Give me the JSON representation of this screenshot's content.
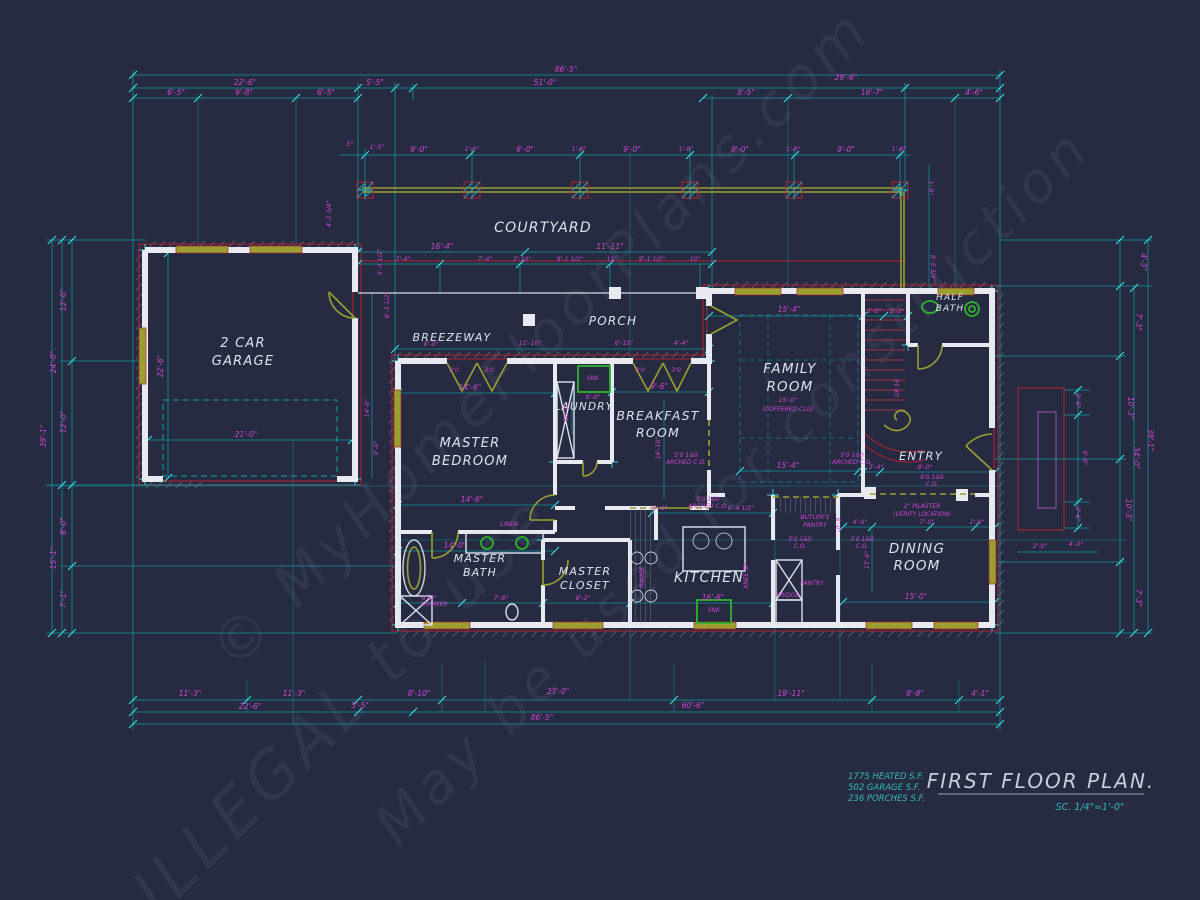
{
  "colors": {
    "background": "#262b42",
    "dimension_line_cyan": "#00bfbf",
    "dimension_text_magenta": "#cf44cf",
    "wall_white": "#e9eaef",
    "door_window_olive": "#9aa02f",
    "accent_red": "#b1212f",
    "fixture_green": "#2db32d",
    "title_teal": "#35b8b8"
  },
  "watermarks": [
    "© MyHomeFloorPlans.com",
    "ILLEGAL to use",
    "May be used for construction"
  ],
  "rooms": {
    "courtyard": "COURTYARD",
    "breezeway": "BREEZEWAY",
    "porch": "PORCH",
    "garage_l1": "2 CAR",
    "garage_l2": "GARAGE",
    "master_l1": "MASTER",
    "master_l2": "BEDROOM",
    "laundry": "LAUNDRY",
    "breakfast_l1": "BREAKFAST",
    "breakfast_l2": "ROOM",
    "family_l1": "FAMILY",
    "family_l2": "ROOM",
    "half_bath_l1": "HALF",
    "half_bath_l2": "BATH",
    "entry": "ENTRY",
    "bath_l1": "MASTER",
    "bath_l2": "BATH",
    "closet_l1": "MASTER",
    "closet_l2": "CLOSET",
    "kitchen": "KITCHEN",
    "dining_l1": "DINING",
    "dining_l2": "ROOM"
  },
  "dims": {
    "top": [
      "86'-5\"",
      "22'-6\"",
      "5'-5\"",
      "51'-0\"",
      "29'-6\"",
      "6'-5\"",
      "9'-8\"",
      "6'-5\"",
      "8'-5\"",
      "16'-7\"",
      "4'-6\""
    ],
    "court": [
      "5\"",
      "1'-5\"",
      "9'-0\"",
      "1'-8\"",
      "9'-0\"",
      "1'-8\"",
      "9'-0\"",
      "1'-8\"",
      "9'-0\"",
      "1'-8\"",
      "9'-0\"",
      "1'-8\"",
      "1'-8\"",
      "8'-5 3/4\""
    ],
    "porch": [
      "16'-4\"",
      "11'-11\"",
      "7'-4\"",
      "7'-4\"",
      "2'-10\"",
      "9'-1 1/2\"",
      "10\"",
      "9'-1 1/2\"",
      "10\""
    ],
    "left": [
      "39'-1\"",
      "12'-0\"",
      "24'-0\"",
      "12'-0\"",
      "8'-0\"",
      "15'-1\"",
      "7'-1\""
    ],
    "right": [
      "4'-3\"",
      "7'-3\"",
      "10'-3\"",
      "10'-3\"",
      "7'-3\"",
      "34'-0\"",
      "39'-1\"",
      "2'-6\"",
      "8'-8\"",
      "2'-6\"",
      "2'-0\"",
      "4'-0\""
    ],
    "bottom": [
      "11'-3\"",
      "11'-3\"",
      "5'-5\"",
      "8'-10\"",
      "23'-0\"",
      "19'-11\"",
      "8'-8\"",
      "4'-1\"",
      "22'-6\"",
      "60'-6\"",
      "86'-5\""
    ],
    "garage": [
      "22'-6\"",
      "21'-0\"",
      "14'-0\"",
      "9'-0\""
    ],
    "interior": [
      "14'-6\"",
      "14'-6\"",
      "16'-0\"",
      "9'-6\"",
      "6'-0\"",
      "8'-0\"",
      "11'-10\"",
      "6'-10\"",
      "4'-4\"",
      "15'-4\"",
      "15'-4\"",
      "16'-10\"",
      "14'-0\"",
      "6'-0\"",
      "7'-8\"",
      "8'-2\"",
      "16'-6\"",
      "9'-6\"",
      "6'-4 1/2\"",
      "6'-0\"",
      "4'-0\"",
      "7'-0\"",
      "2'-8\"",
      "13'-0\"",
      "15'-0\"",
      "8'-0\"",
      "2'-4\"",
      "2'-0\"",
      "2'-2\"",
      "15'-0\"",
      "4'-2 3/4\"",
      "5'-3 1/2\"",
      "6'-3 1/2\""
    ],
    "door_labels": [
      "3'0",
      "3'0",
      "3'0",
      "3'0"
    ]
  },
  "annotations": {
    "arch_l1": "5'0 1&0",
    "arch_l2": "ARCHED C.O.",
    "co_l1": "3'0 1&0",
    "co_l2": "C.O.",
    "entry_l1": "6'0 1&0",
    "entry_l2": "C.O.",
    "pilaster_l1": "2\" PILASTER",
    "pilaster_l2": "(VERIFY LOCATION)",
    "coffered": "(COFFERED CLG)",
    "up": "UP 16",
    "knee": "KNEE SP",
    "range": "RANGE",
    "linen": "LINEN",
    "snk": "SNK",
    "shower": "SHOWER",
    "fridge": "FRIDGE",
    "pantry": "PANTRY",
    "butlers_l1": "BUTLER'S",
    "butlers_l2": "PANTRY"
  },
  "title_block": {
    "area1": "1775 HEATED S.F.",
    "area2": "502 GARAGE S.F.",
    "area3": "236 PORCHES S.F.",
    "title": "FIRST FLOOR PLAN.",
    "scale": "SC. 1/4\"=1'-0\""
  }
}
